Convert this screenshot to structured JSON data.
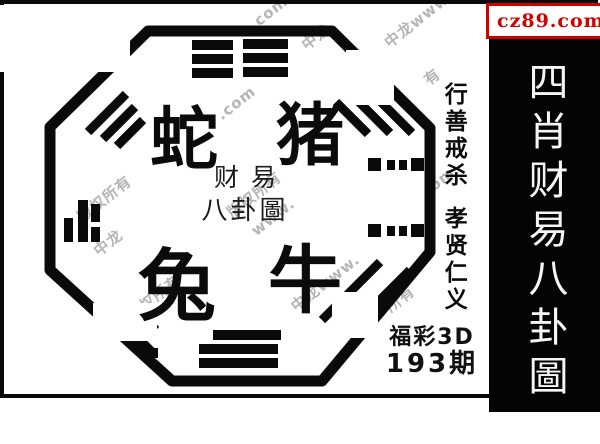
{
  "logo": {
    "text": "cz89.com",
    "color": "#d40000",
    "square_color": "#ffe900",
    "border_color": "#cf0000"
  },
  "sidebar": {
    "title": "四肖财易八卦圖",
    "bg_color": "#040404",
    "text_color": "#f5f5f5"
  },
  "motto": {
    "line1": "行善戒杀",
    "line2": "孝贤仁义"
  },
  "issue": {
    "game": "福彩3D",
    "period": "193期"
  },
  "seal": {
    "line1": "财易",
    "line2": "八卦圖"
  },
  "zodiac": {
    "top_left": "蛇",
    "top_right": "猪",
    "bottom_left": "兔",
    "bottom_right": "牛"
  },
  "watermarks": [
    {
      "text": ".com"
    },
    {
      "text": "中龙"
    },
    {
      "text": "中龙www"
    },
    {
      "text": "有"
    },
    {
      "text": "版权所有"
    },
    {
      "text": "中龙"
    },
    {
      "text": "版权所有"
    },
    {
      "text": "www."
    },
    {
      "text": "权所有"
    },
    {
      "text": "中龙www."
    },
    {
      "text": "所有"
    },
    {
      "text": ".com"
    },
    {
      "text": "om"
    }
  ]
}
